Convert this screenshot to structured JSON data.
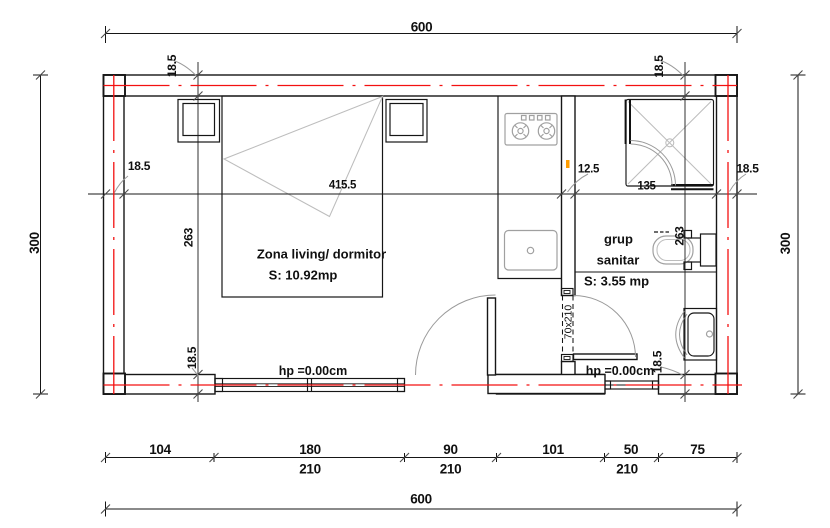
{
  "rooms": {
    "living": {
      "name": "Zona living/ dormitor",
      "area": "S: 10.92mp"
    },
    "bathroom": {
      "line1": "grup",
      "line2": "sanitar",
      "area": "S: 3.55 mp"
    }
  },
  "annotations": {
    "floor_level_left": "hp =0.00cm",
    "floor_level_right": "hp =0.00cm",
    "bathroom_door_size": "70x210"
  },
  "dimensions": {
    "top_total": "600",
    "bottom_total": "600",
    "left_total": "300",
    "right_total": "300",
    "bottom_segments": [
      "104",
      "180",
      "90",
      "101",
      "50",
      "75"
    ],
    "bottom_openings": [
      "210",
      "210",
      "210"
    ],
    "h_chain": [
      "18.5",
      "415.5",
      "12.5",
      "135",
      "18.5"
    ],
    "v_chain_left": [
      "18.5",
      "263",
      "18.5"
    ],
    "v_chain_right": [
      "18.5",
      "263",
      "18.5"
    ]
  },
  "colors": {
    "axis_red": "#f31111",
    "drawing_black": "#161616",
    "furniture_grey": "#a0a0a0"
  }
}
